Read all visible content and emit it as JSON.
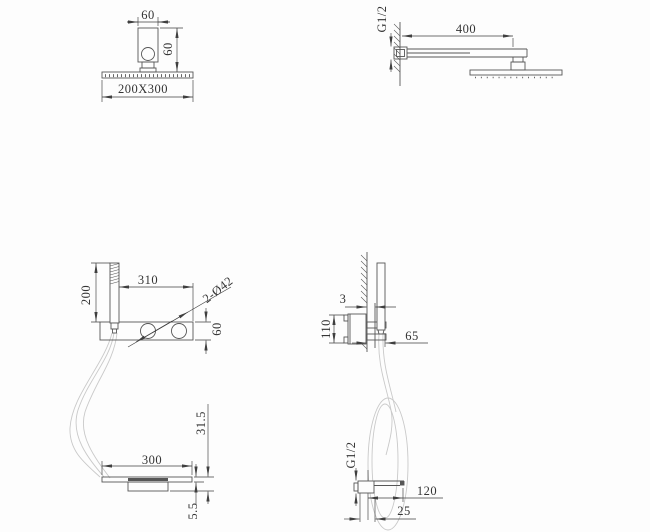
{
  "title": "shower-system-technical-drawing",
  "colors": {
    "background": "#fdfdfd",
    "line": "#565656",
    "dim": "#3f3f3f",
    "hose": "#c9c9c9"
  },
  "views": {
    "overhead_front": {
      "label": "overhead-shower-front-view",
      "dims": {
        "arm_width": "60",
        "drop_height": "60",
        "head_size": "200X300"
      }
    },
    "overhead_side": {
      "label": "overhead-shower-side-view",
      "dims": {
        "thread": "G1/2",
        "arm_length": "400"
      }
    },
    "mixer_front": {
      "label": "mixer-panel-front-view",
      "dims": {
        "handshower_height": "200",
        "body_width": "310",
        "holes": "2-Ø42",
        "body_height": "60"
      }
    },
    "mixer_side": {
      "label": "mixer-panel-side-view",
      "dims": {
        "trim_thickness": "3",
        "valve_height": "110",
        "offset": "65"
      }
    },
    "spout_front": {
      "label": "waterfall-spout-front-view",
      "dims": {
        "height": "31.5",
        "width": "300",
        "lip": "5.5"
      }
    },
    "spout_side": {
      "label": "waterfall-spout-side-view",
      "dims": {
        "thread": "G1/2",
        "length": "120",
        "inset": "25"
      }
    }
  }
}
